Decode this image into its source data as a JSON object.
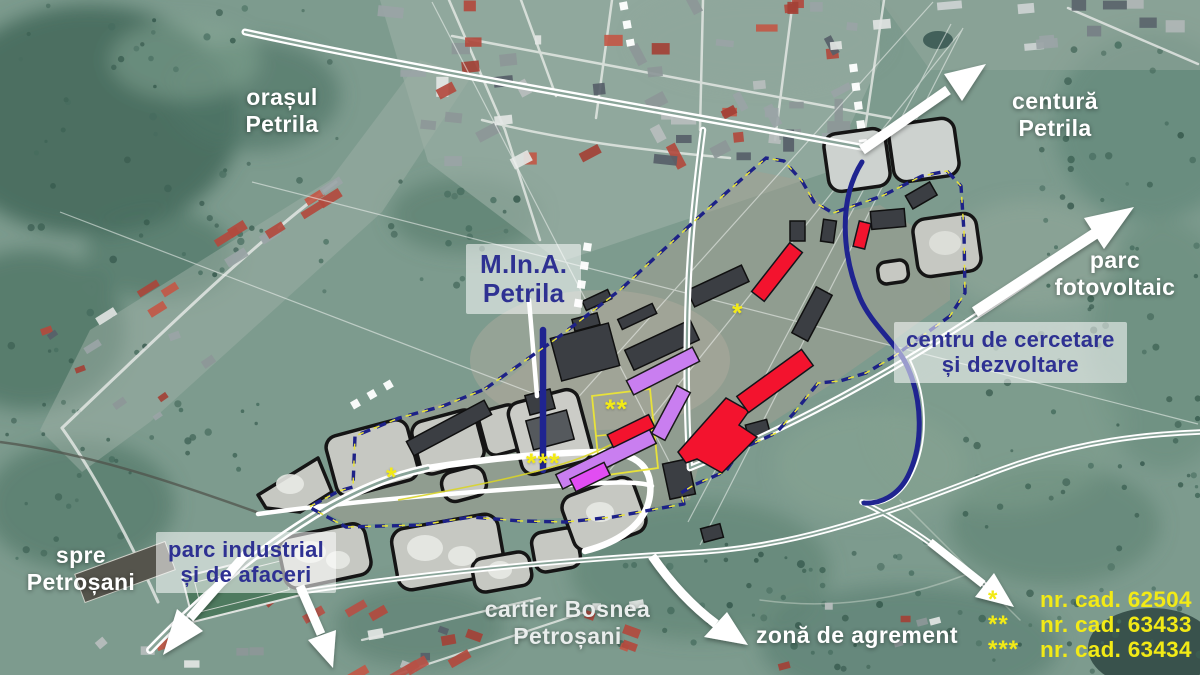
{
  "map": {
    "labels": {
      "orasul_petrila": {
        "lines": [
          "orașul",
          "Petrila"
        ]
      },
      "centura_petrila": {
        "lines": [
          "centură",
          "Petrila"
        ]
      },
      "parc_fotovoltaic": {
        "lines": [
          "parc",
          "fotovoltaic"
        ]
      },
      "mina_petrila": {
        "lines": [
          "M.In.A.",
          "Petrila"
        ]
      },
      "centru_cercetare": {
        "lines": [
          "centru de cercetare",
          "și dezvoltare"
        ]
      },
      "parc_industrial": {
        "lines": [
          "parc industrial",
          "și de afaceri"
        ]
      },
      "spre_petrosani": {
        "lines": [
          "spre",
          "Petroșani"
        ]
      },
      "cartier_bosnea": {
        "lines": [
          "cartier Bosnea",
          "Petroșani"
        ]
      },
      "zona_agrement": {
        "text": "zonă de agrement"
      }
    },
    "markers": [
      {
        "symbol": "*"
      },
      {
        "symbol": "*"
      },
      {
        "symbol": "**"
      },
      {
        "symbol": "***"
      }
    ],
    "legend": {
      "items": [
        {
          "marker": "*",
          "label": "nr. cad. 62504"
        },
        {
          "marker": "**",
          "label": "nr. cad. 63433"
        },
        {
          "marker": "***",
          "label": "nr. cad. 63434"
        }
      ]
    },
    "colors": {
      "label_navy": "#2e3192",
      "label_white": "#ffffff",
      "legend_yellow": "#f2ea16",
      "boundary_navy": "#1d2187",
      "boundary_yellow": "#e8e23a",
      "proposed_red": "#f3132e",
      "proposed_purple": "#c97ef0",
      "proposed_magenta": "#e14df2",
      "plot_gray": "#c6c8c2",
      "road_white": "#ffffff"
    }
  }
}
